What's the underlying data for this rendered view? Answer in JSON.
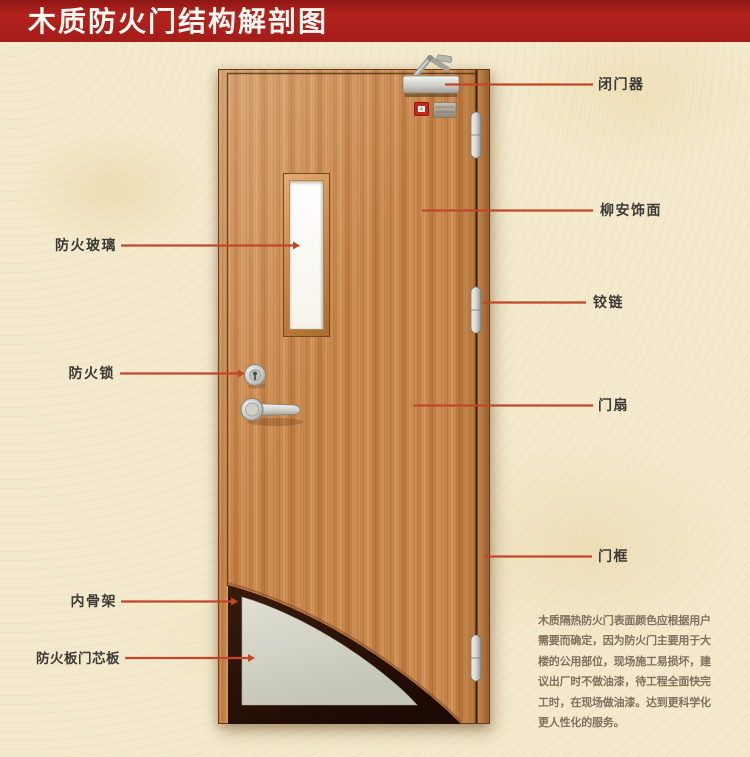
{
  "title": "木质防火门结构解剖图",
  "colors": {
    "banner_red": "#a41d19",
    "callout_line_red": "#c2472a",
    "door_wood": "#c8854a",
    "core_board_gray": "#d6d5ca",
    "inner_skeleton_dark": "#2a1208",
    "background_cream": "#f3e9cd",
    "label_text": "#3d3a35",
    "indicator_red": "#c3271d"
  },
  "callouts": {
    "right": [
      {
        "id": "door-closer",
        "label": "闭门器"
      },
      {
        "id": "lauan-veneer",
        "label": "柳安饰面"
      },
      {
        "id": "hinge",
        "label": "铰链"
      },
      {
        "id": "door-leaf",
        "label": "门扇"
      },
      {
        "id": "door-frame",
        "label": "门框"
      }
    ],
    "left": [
      {
        "id": "fire-glass",
        "label": "防火玻璃"
      },
      {
        "id": "fire-lock",
        "label": "防火锁"
      },
      {
        "id": "inner-skeleton",
        "label": "内骨架"
      },
      {
        "id": "fire-board-core",
        "label": "防火板门芯板"
      }
    ]
  },
  "description": {
    "lines": [
      "木质隔热防火门表面颜色应根据用户",
      "需要而确定，因为防火门主要用于大",
      "楼的公用部位，现场施工易损坏，建",
      "议出厂时不做油漆，待工程全面快完",
      "工时，在现场做油漆。达到更科学化",
      "更人性化的服务。"
    ]
  }
}
